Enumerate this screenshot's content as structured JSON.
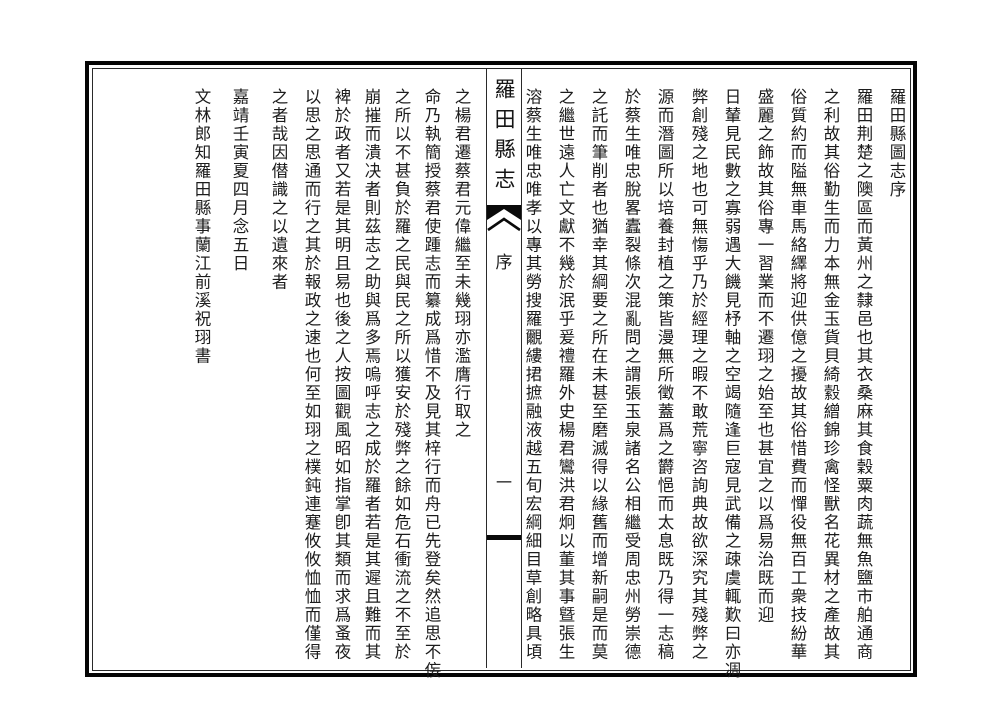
{
  "center_strip": {
    "title": "羅田縣志",
    "section_label": "序",
    "page_number": "一"
  },
  "right_page": {
    "columns": [
      "羅田縣圖志序",
      "羅田荆楚之隩區而黃州之隸邑也其衣桑麻其食穀粟肉蔬無魚鹽市舶通商",
      "之利故其俗勤生而力本無金玉貨貝綺縠繒錦珍禽怪獸名花異材之產故其",
      "俗質約而隘無車馬絡繹將迎供億之擾故其俗惜費而憚役無百工衆技紛華",
      "盛麗之飾故其俗專一習業而不遷珝之始至也甚宜之以爲易治既而迎",
      "日輦見民數之寡弱遇大饑見杼軸之空竭隨逢巨寇見武備之疎虞輒歎曰亦凋",
      "弊創殘之地也可無慯乎乃於經理之暇不敢荒寧咨詢典故欲深究其殘弊之",
      "源而潛圖所以培養封植之策皆漫無所徵蓋爲之欝悒而太息既乃得一志稿",
      "於蔡生唯忠脫畧蠹裂條次混亂問之謂張玉泉諸名公相繼受周忠州勞崇德",
      "之託而筆削者也猶幸其綱要之所在未甚至磨滅得以緣舊而增新嗣是而莫",
      "之繼世遠人亡文獻不幾於泯乎爰禮羅外史楊君鸞洪君炯以董其事曁張生",
      "溶蔡生唯忠唯孝以專其勞搜羅覼縷捃摭融液越五旬宏綱細目草創略具頃"
    ]
  },
  "left_page": {
    "columns": [
      "之楊君遷蔡君元偉繼至未幾珝亦濫膺行取之",
      "命乃執簡授蔡君使踵志而纂成爲惜不及見其梓行而舟已先登矣然追思不侫",
      "之所以不甚負於羅之民與民之所以獲安於殘弊之餘如危石衝流之不至於",
      "崩摧而潰决者則茲志之助與爲多焉嗚呼志之成於羅者若是其遲且難而其",
      "裨於政者又若是其明且易也後之人按圖觀風昭如指掌卽其類而求爲蚤夜",
      "以思之思通而行之其於報政之速也何至如珝之樸鈍連蹇攸攸恤恤而僅得",
      "之者哉因僣識之以遺來者",
      "嘉靖壬寅夏四月念五日",
      "文林郎知羅田縣事蘭江前溪祝珝書"
    ]
  },
  "colors": {
    "ink": "#1a1a1a",
    "paper": "#ffffff",
    "border": "#050505"
  }
}
